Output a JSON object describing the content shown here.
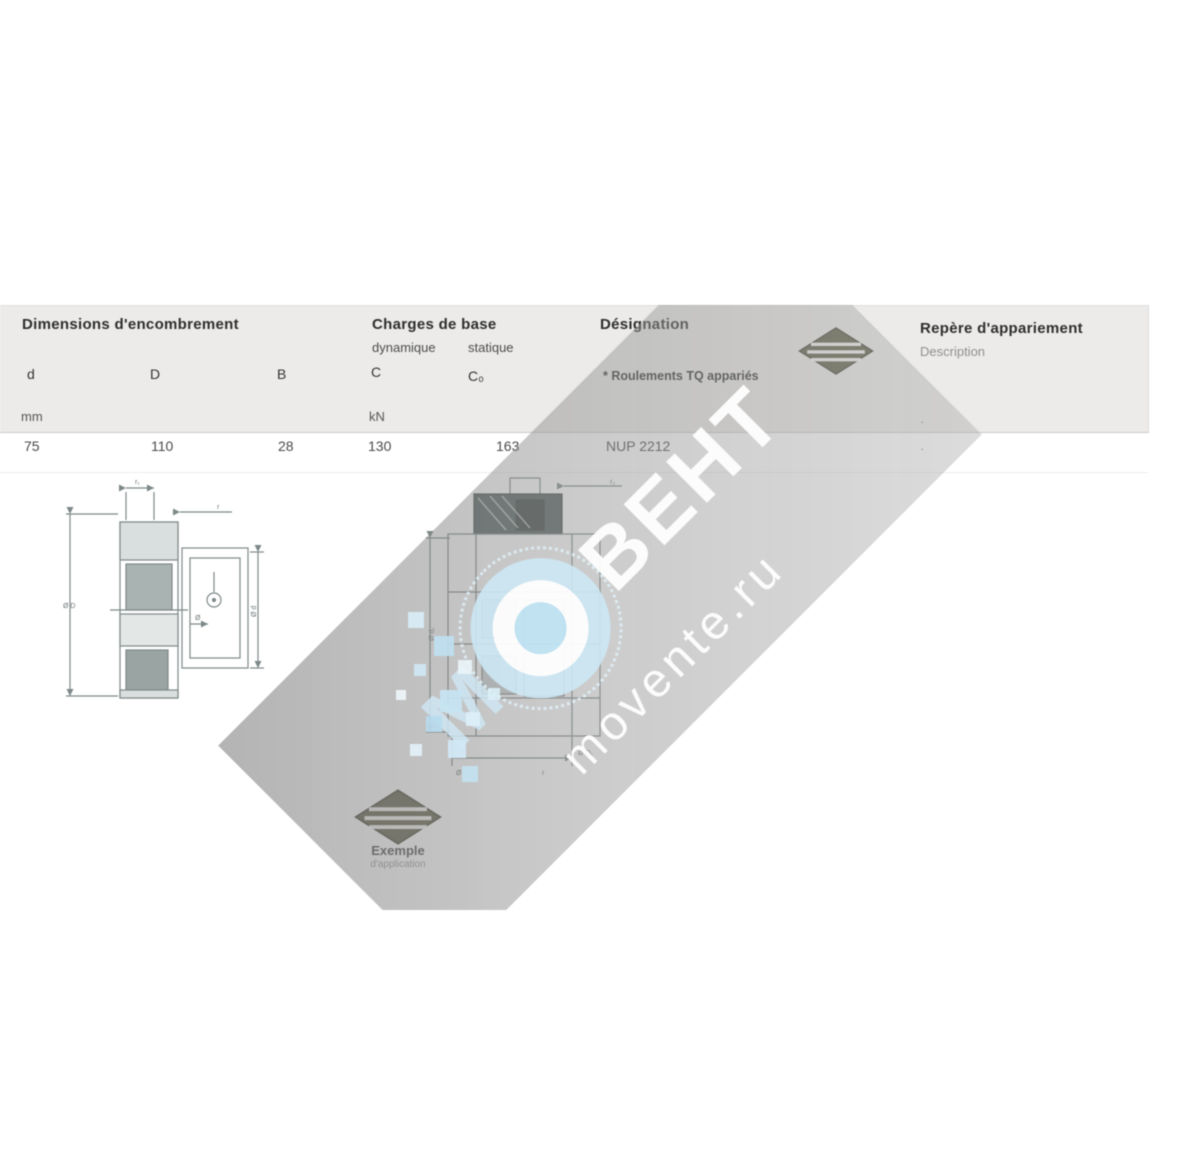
{
  "table": {
    "groups": {
      "dimensions": {
        "title": "Dimensions d'encombrement"
      },
      "charges": {
        "title": "Charges de base",
        "dyn": "dynamique",
        "stat": "statique"
      },
      "designation": {
        "title": "Désignation",
        "footnote": "* Roulements TQ appariés"
      },
      "repere": {
        "title": "Repère d'appariement",
        "sub": "Description"
      }
    },
    "cols": {
      "d": "d",
      "D": "D",
      "B": "B",
      "C": "C",
      "C0": "C₀"
    },
    "units": {
      "mm": "mm",
      "kn": "kN"
    },
    "row": {
      "d": "75",
      "D": "110",
      "B": "28",
      "C": "130",
      "C0": "163",
      "designation": "NUP 2212",
      "mark1": "·",
      "mark2": "·"
    }
  },
  "diagrams": {
    "left": {
      "dim_top": "r₁",
      "dim_r": "r",
      "dim_left": "Ø D",
      "dim_right": "Ø d",
      "dim_inner": "Ø"
    },
    "center": {
      "dim_top": "r₂",
      "dim_left": "Ø d₁",
      "dim_bottom": "Ø D₁",
      "note1": "Ø",
      "note2": "r"
    }
  },
  "watermark": {
    "m": "М",
    "vent": "ВЕНТ",
    "url": "movente.ru"
  },
  "logos": {
    "caption": "Exemple",
    "subcaption": "d'application"
  }
}
